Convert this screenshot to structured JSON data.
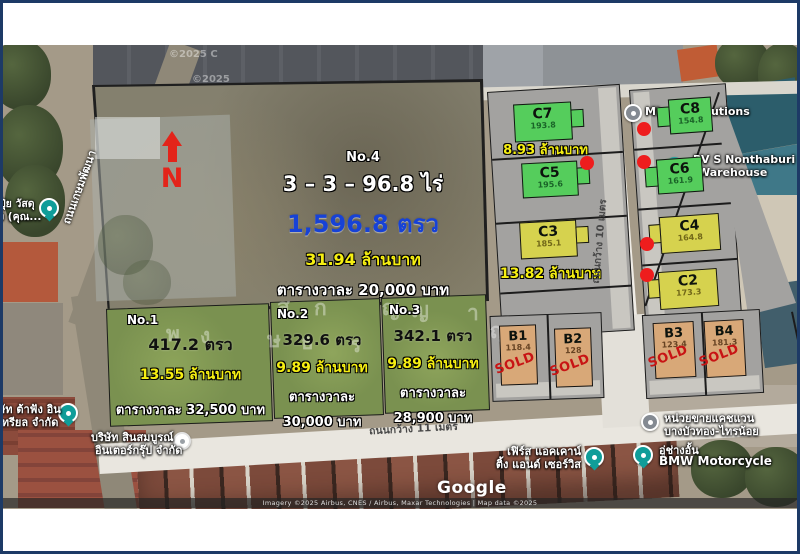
{
  "north_label": "N",
  "plot4": {
    "no": "No.4",
    "rai": "3 – 3 – 96.8 ไร่",
    "area": "1,596.8 ตรว",
    "price": "31.94 ล้านบาท",
    "per_wah": "ตารางวาละ 20,000 บาท"
  },
  "plot1": {
    "no": "No.1",
    "area": "417.2 ตรว",
    "price": "13.55 ล้านบาท",
    "per_wah": "ตารางวาละ 32,500 บาท"
  },
  "plot2": {
    "no": "No.2",
    "area": "329.6 ตรว",
    "price": "9.89 ล้านบาท",
    "per_wah_1": "ตารางวาละ",
    "per_wah_2": "30,000 บาท"
  },
  "plot3": {
    "no": "No.3",
    "area": "342.1 ตรว",
    "price": "9.89 ล้านบาท",
    "per_wah_1": "ตารางวาละ",
    "per_wah_2": "28,900 บาท"
  },
  "c_units": [
    {
      "id": "C7",
      "area": "193.8"
    },
    {
      "id": "C5",
      "area": "195.6"
    },
    {
      "id": "C3",
      "area": "185.1"
    },
    {
      "id": "C8",
      "area": "154.8"
    },
    {
      "id": "C6",
      "area": "161.9"
    },
    {
      "id": "C4",
      "area": "164.8"
    },
    {
      "id": "C2",
      "area": "173.3"
    }
  ],
  "c_price_top": "8.93 ล้านบาท",
  "c_price_bottom": "13.82 ล้านบาท",
  "b_units": [
    {
      "id": "B1",
      "area": "118.4",
      "sold": "SOLD"
    },
    {
      "id": "B2",
      "area": "128",
      "sold": "SOLD"
    },
    {
      "id": "B3",
      "area": "123.4",
      "sold": "SOLD"
    },
    {
      "id": "B4",
      "area": "181.3",
      "sold": "SOLD"
    }
  ],
  "roads": {
    "bottom": "ถนนกว้าง 11 เมตร",
    "middle": "ถนนกว้าง 10 เมตร",
    "left": "ถนนเกษมพัฒนา"
  },
  "places": {
    "mirage": "Mirage Solutions",
    "pvs_1": "PV S Nonthaburi",
    "pvs_2": "Warehouse",
    "cashvan_1": "หน่วยขายแคชแวน",
    "cashvan_2": "บางบัวทอง-ไทรน้อย",
    "bmw_1": "อู่ช่างอั้น",
    "bmw_2": "BMW Motorcycle",
    "first_1": "เฟิร์ส แอคเคาน์",
    "first_2": "ติ้ง แอนด์ เซอร์วิส",
    "sin_1": "บริษัท สินสมบูรณ์",
    "sin_2": "อินเตอร์กรุ๊ป จำกัด",
    "dafang_1": "ษัท ต้าฟัง อิน",
    "dafang_2": "เทรียล จำกัด",
    "fert_1": "ปุ๋ย วัสดุ",
    "fert_2": "ง (คุณ..."
  },
  "google": {
    "logo": "Google",
    "attribution": "Imagery ©2025 Airbus, CNES / Airbus, Maxar Technologies | Map data ©2025"
  },
  "imagery_marks": {
    "m1": "©2025 C",
    "m2": "©2025"
  },
  "watermark_letters": [
    "พ",
    "ง",
    "ส",
    "ก",
    "ษ",
    "ธ",
    "ร",
    "ญ",
    "ญ",
    "า",
    "ญ"
  ]
}
